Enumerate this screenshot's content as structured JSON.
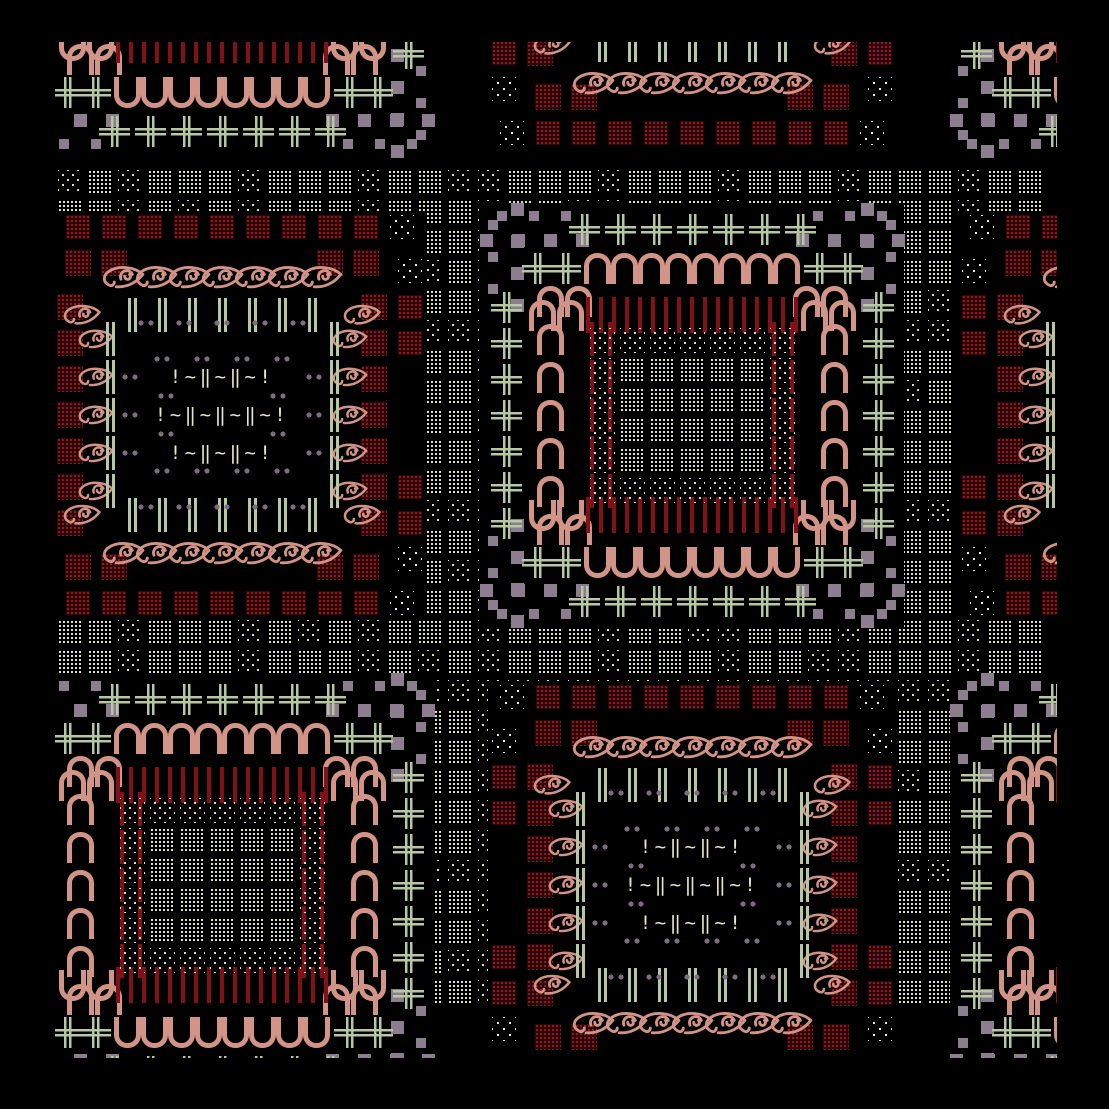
{
  "canvas": {
    "width": 1109,
    "height": 1109
  },
  "frame": {
    "left": 55,
    "top": 42,
    "width": 1002,
    "height": 1016
  },
  "palette": {
    "background": "#000000",
    "salmon": "#d29487",
    "green": "#b7c7a1",
    "cream_dot": "#dcdfc4",
    "white_dot": "#ededed",
    "red_bar": "#801116",
    "red_block_base": "#2c0608",
    "red_block_dot": "#8f1b1e",
    "mauve": "#8d7e8f",
    "mauve_dot": "#7d6e82",
    "text_cream": "#e9e6c9"
  },
  "tiling": {
    "period": 470,
    "origin_x": 222,
    "origin_y": -55,
    "cols": 3,
    "rows": 3,
    "checker_types": [
      "arch",
      "eye"
    ]
  },
  "background_texture": {
    "x0": 58,
    "x1": 1034,
    "y0": 170,
    "y1": 980,
    "pitch": 30,
    "block": 24,
    "sparse_col_mod": 4,
    "sparse_row_mod": 6,
    "sparse_hash_mod": 13
  },
  "arch_med": {
    "half": 212,
    "mauve_rings": [
      {
        "r": 175,
        "size": 13,
        "arm": [
          110,
          142,
          174,
          206
        ]
      },
      {
        "r": 199,
        "size": 10,
        "arm": [
          126,
          158,
          190
        ]
      }
    ],
    "hash_ring": {
      "r": 186,
      "step": 36,
      "half_count": 3
    },
    "arch_ring": {
      "row_r": 147,
      "row_step": 27,
      "row_pairs": 4,
      "col_r": 142,
      "col_step": 38,
      "col_half": 3,
      "corner_hash": [
        127,
        155
      ]
    },
    "bar_ring": {
      "row_r": 100,
      "row_step": 13,
      "row_half": 8,
      "bar_w": 4,
      "bar_h": 36,
      "corner_arch": [
        122,
        150
      ],
      "col_x": [
        82,
        100
      ],
      "col_step": 38,
      "col_half": 2
    },
    "core": {
      "cell": 30,
      "block": 25,
      "cols_half": 3,
      "row_centers": [
        -75,
        -45,
        -15,
        15,
        45,
        75
      ],
      "dense_col_max": 2,
      "dense_row_max": 46
    }
  },
  "eye_med": {
    "half": 204,
    "ring2": {
      "r": 188,
      "step": 36,
      "block": 24,
      "row_half": 5,
      "col_half": 4,
      "col_min": 2
    },
    "ring1": {
      "r": 152,
      "step": 36,
      "block": 26,
      "row_ks": [
        -4,
        -3,
        3,
        4
      ],
      "col_half": 3
    },
    "eyes_row": {
      "r": 138,
      "step": 33,
      "half": 3,
      "scale": 0.95
    },
    "bars_row": {
      "r": 100,
      "step": 30,
      "half": 3,
      "end_eye_dx": 140
    },
    "eyes_col": {
      "r": 127,
      "step": 38,
      "half": 2,
      "scale": 0.8
    },
    "dbar_col": {
      "r": 112,
      "step": 38,
      "half": 2
    },
    "dots_rings": [
      {
        "r": 92,
        "row_dxs": [
          -76,
          -38,
          0,
          38,
          76
        ],
        "col_dys": [
          -38,
          0,
          38
        ]
      },
      {
        "r": 56,
        "row_dxs": [
          -60,
          -20,
          20,
          60
        ],
        "col_dys": [
          -19,
          19
        ]
      }
    ],
    "center_rows": [
      {
        "dy": -38,
        "text": "!~‖~‖~!"
      },
      {
        "dy": 0,
        "text": "!~‖~‖~‖~!"
      },
      {
        "dy": 38,
        "text": "!~‖~‖~!"
      }
    ]
  },
  "eye_glyph": {
    "width": 46,
    "height": 30,
    "stroke_width": 3,
    "paths": [
      "M44 12 C36 4 18 2 8 9 C2 13 2 20 8 23 C11 25 14 23 14 20",
      "M44 12 C38 20 28 26 16 25",
      "M21 17 A6.5 6.5 0 1 1 33 12",
      "M25 14 A3 3 0 1 0 30 12"
    ]
  }
}
